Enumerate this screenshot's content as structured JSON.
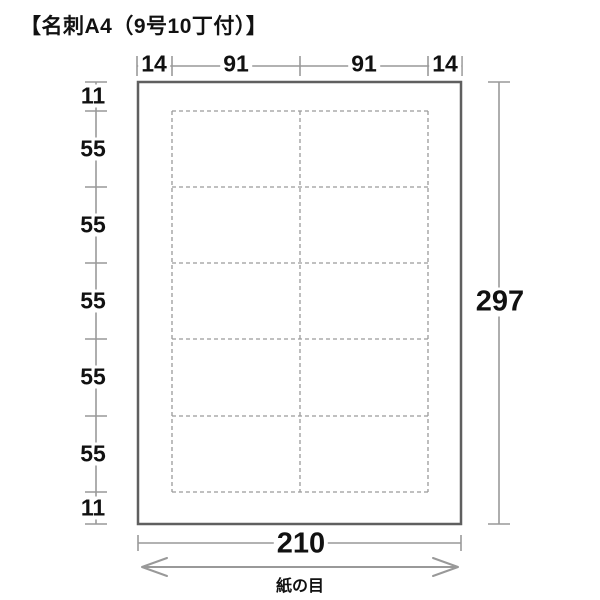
{
  "title": "【名刺A4（9号10丁付）】",
  "dimensions": {
    "top": [
      "14",
      "91",
      "91",
      "14"
    ],
    "left": [
      "11",
      "55",
      "55",
      "55",
      "55",
      "55",
      "11"
    ],
    "right": "297",
    "bottom": "210"
  },
  "grain_label": "紙の目",
  "card_grid": {
    "columns": 2,
    "rows": 5
  },
  "colors": {
    "dimension_line": "#999999",
    "paper_border": "#5f5f5f",
    "dashed_cut_line": "#9a9a9a",
    "text": "#111111"
  }
}
